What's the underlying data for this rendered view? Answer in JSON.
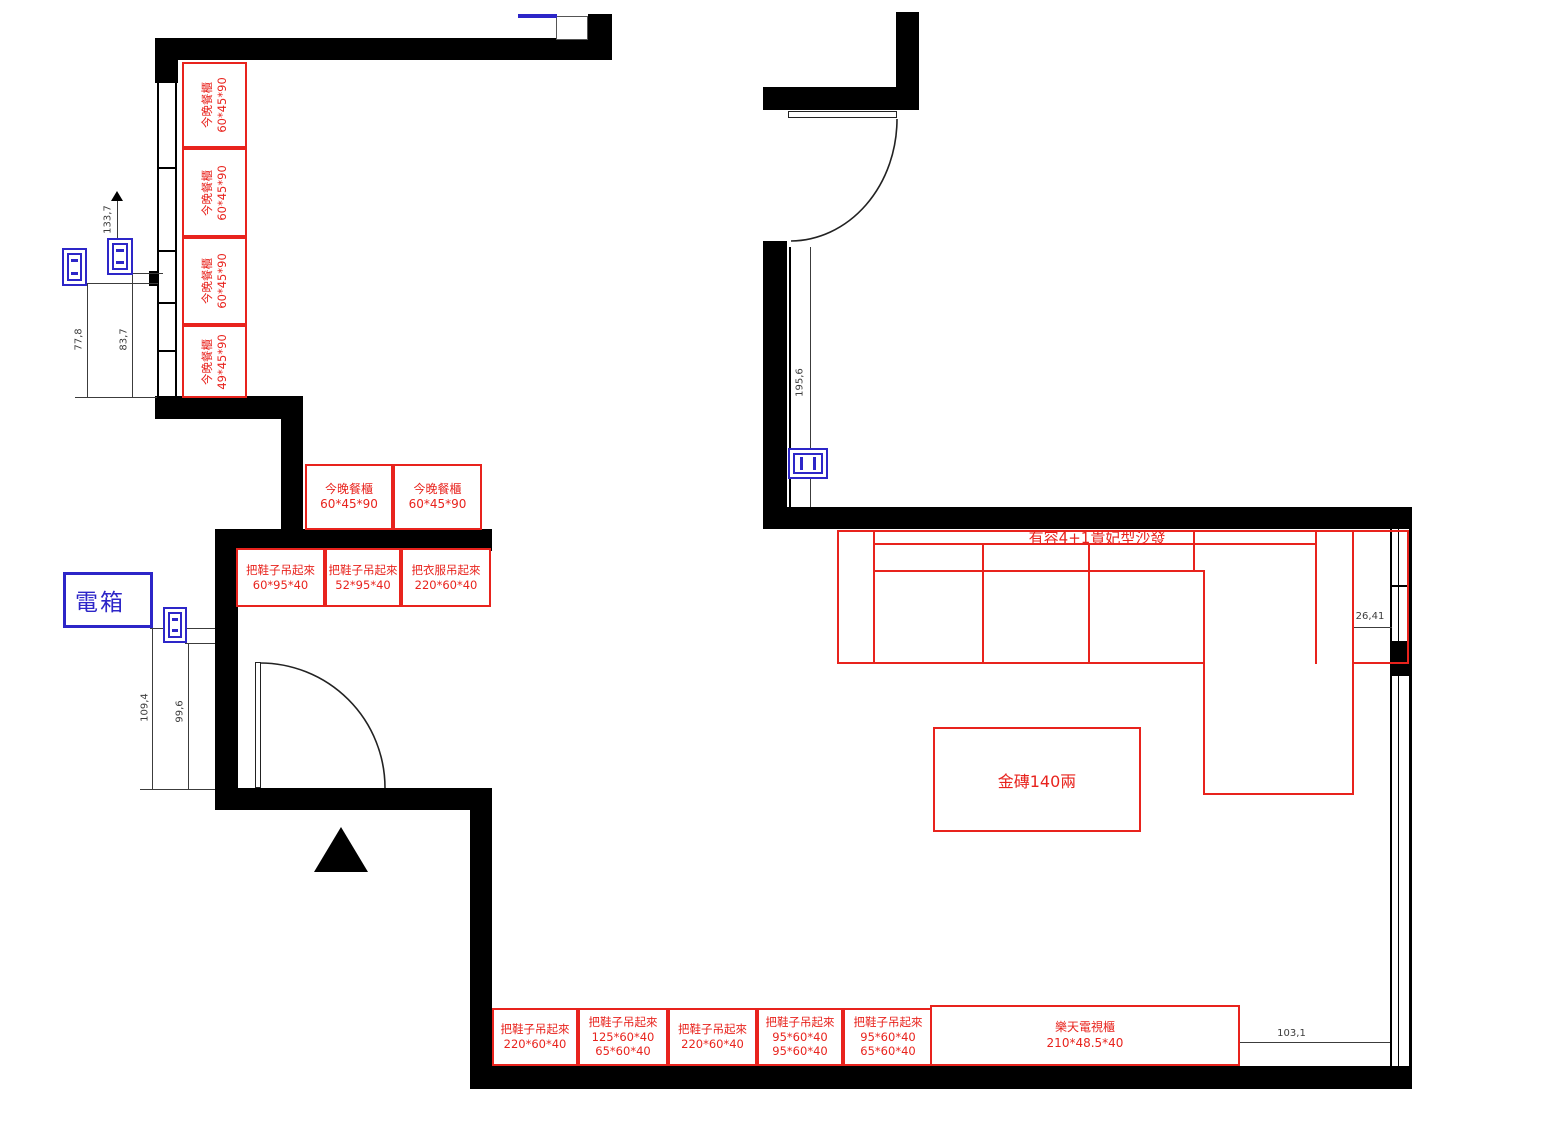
{
  "colors": {
    "red": "#e8231d",
    "blue": "#2d26c8",
    "wall": "#000000",
    "dim_text": "#3c3c3c"
  },
  "labels": {
    "electrical_box": "電箱",
    "sofa": "有容4+1貴妃型沙發",
    "gold_brick": "金磚140兩"
  },
  "dimensions": {
    "d133_7": "133,7",
    "d77_8": "77,8",
    "d83_7": "83,7",
    "d109_4": "109,4",
    "d99_6": "99,6",
    "d195_6": "195,6",
    "d26_41": "26,41",
    "d103_1": "103,1"
  },
  "furniture": {
    "left_column": [
      {
        "name": "今晚餐櫃",
        "size": "60*45*90"
      },
      {
        "name": "今晚餐櫃",
        "size": "60*45*90"
      },
      {
        "name": "今晚餐櫃",
        "size": "60*45*90"
      },
      {
        "name": "今晚餐櫃",
        "size": "49*45*90"
      }
    ],
    "mid_row": [
      {
        "name": "今晚餐櫃",
        "size": "60*45*90"
      },
      {
        "name": "今晚餐櫃",
        "size": "60*45*90"
      }
    ],
    "entry_row": [
      {
        "name": "把鞋子吊起來",
        "size": "60*95*40"
      },
      {
        "name": "把鞋子吊起來",
        "size": "52*95*40"
      },
      {
        "name": "把衣服吊起來",
        "size": "220*60*40"
      }
    ],
    "bottom_row": [
      {
        "name": "把鞋子吊起來",
        "size": "220*60*40"
      },
      {
        "name": "把鞋子吊起來",
        "size": "125*60*40",
        "size2": "65*60*40"
      },
      {
        "name": "把鞋子吊起來",
        "size": "220*60*40"
      },
      {
        "name": "把鞋子吊起來",
        "size": "95*60*40",
        "size2": "95*60*40"
      },
      {
        "name": "把鞋子吊起來",
        "size": "95*60*40",
        "size2": "65*60*40"
      },
      {
        "name": "樂天電視櫃",
        "size": "210*48.5*40"
      }
    ]
  }
}
